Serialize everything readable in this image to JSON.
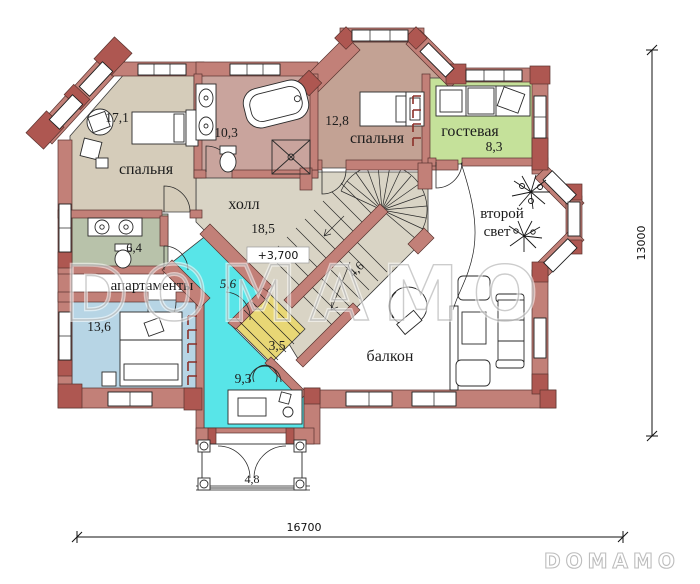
{
  "watermark": "DOMAMO",
  "logo": "DOMAMO",
  "elevation_mark": "+3,700",
  "dimensions": {
    "bottom": "16700",
    "right": "13000"
  },
  "rooms": [
    {
      "id": "bedroom-1",
      "name": "спальня",
      "area": "17,1"
    },
    {
      "id": "bathroom-1",
      "name": "",
      "area": "10,3"
    },
    {
      "id": "bedroom-2",
      "name": "спальня",
      "area": "12,8"
    },
    {
      "id": "guest-room",
      "name": "гостевая",
      "area": "8,3"
    },
    {
      "id": "hall",
      "name": "холл",
      "area": "18,5"
    },
    {
      "id": "second-light",
      "name_lines": [
        "второй",
        "свет"
      ]
    },
    {
      "id": "bathroom-2",
      "name": "",
      "area": "6,4"
    },
    {
      "id": "apartments",
      "name": "апартаменты",
      "area": "5,6"
    },
    {
      "id": "bedroom-3",
      "name": "",
      "area": "13,6"
    },
    {
      "id": "closet",
      "name": "",
      "area": "3,5"
    },
    {
      "id": "office",
      "name": "",
      "area": "9,3"
    },
    {
      "id": "balcony",
      "name": "балкон",
      "area": ""
    },
    {
      "id": "stairs",
      "name": "",
      "area": "4,6"
    },
    {
      "id": "porch",
      "name": "",
      "area": "4,8"
    }
  ],
  "icons": [
    "bed-icon",
    "bathtub-icon",
    "sink-icon",
    "toilet-icon",
    "shower-icon",
    "sofa-icon",
    "armchair-icon",
    "desk-icon",
    "chair-icon",
    "table-icon",
    "plant-icon",
    "stairs-icon",
    "wardrobe-mark-icon",
    "column-icon",
    "door-arc-icon",
    "window-icon"
  ],
  "colors": {
    "wall": "#c28078",
    "wall_dark": "#ae5751",
    "bedroom_17": "#d5ccba",
    "bathroom_10": "#c9a49d",
    "bedroom_12": "#c3a294",
    "guest": "#c5e19a",
    "hall": "#d9d4c5",
    "bathroom_6": "#b8c2aa",
    "apartment_13": "#b7d5e5",
    "office_cyan": "#58e5e8",
    "closet_yellow": "#e8d775",
    "floor_white": "#ffffff"
  }
}
